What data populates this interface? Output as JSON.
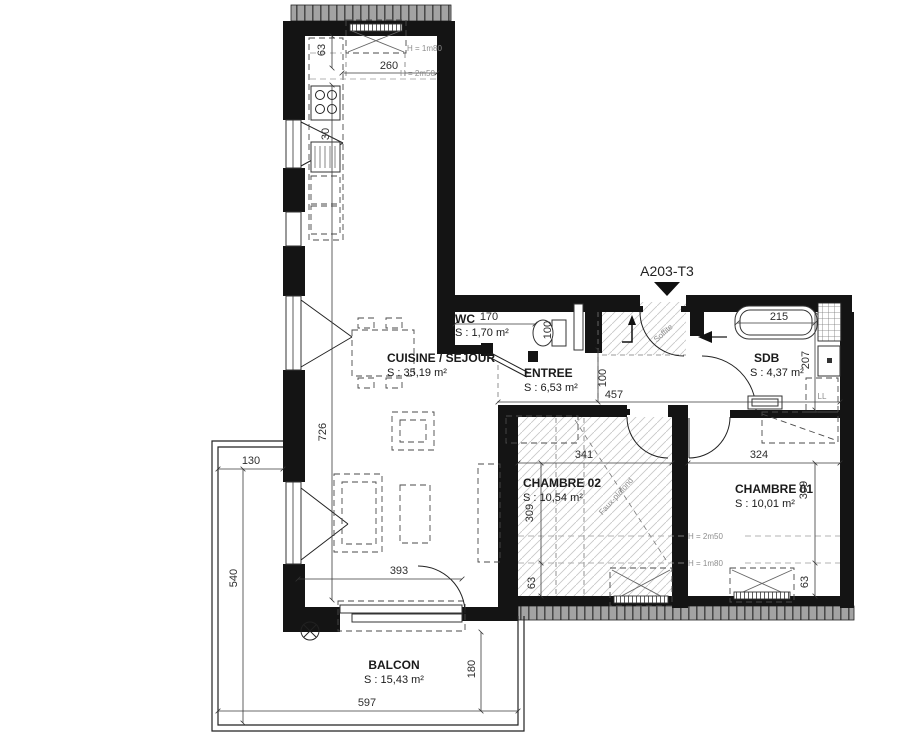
{
  "title": {
    "unit": "A203-T3"
  },
  "rooms": {
    "cuisine": {
      "name": "CUISINE / SEJOUR",
      "area": "S : 35,19 m²"
    },
    "wc": {
      "name": "WC",
      "area": "S : 1,70 m²"
    },
    "entree": {
      "name": "ENTREE",
      "area": "S : 6,53 m²"
    },
    "sdb": {
      "name": "SDB",
      "area": "S : 4,37 m²"
    },
    "chambre02": {
      "name": "CHAMBRE 02",
      "area": "S : 10,54 m²"
    },
    "chambre01": {
      "name": "CHAMBRE 01",
      "area": "S : 10,01 m²"
    },
    "balcon": {
      "name": "BALCON",
      "area": "S : 15,43 m²"
    }
  },
  "dims": {
    "top_63": "63",
    "top_260": "260",
    "kitchen_30": "30",
    "sejour_726": "726",
    "balcon_130": "130",
    "balcon_540": "540",
    "balcon_597": "597",
    "balcon_180": "180",
    "door_393": "393",
    "wc_170": "170",
    "wc_100": "100",
    "hall_457": "457",
    "hall_100": "100",
    "tub_215": "215",
    "sdb_207": "207",
    "c02_341": "341",
    "c02_309": "309",
    "c02_63": "63",
    "c01_324": "324",
    "c01_309": "309",
    "c01_63": "63"
  },
  "annotations": {
    "h_1m80_top": "H = 1m80",
    "h_2m50_top": "H = 2m50",
    "h_2m50_rooms": "H = 2m50",
    "h_1m80_rooms": "H = 1m80",
    "soffite": "Soffite",
    "faux_plafond": "Faux-plafond",
    "washer": "LL"
  },
  "colors": {
    "wall": "#141414",
    "roof_band": "#a3a3a3",
    "hatch": "#c9c9c9",
    "dim_text": "#2e2e2e",
    "muted_text": "#8d8d8d"
  }
}
